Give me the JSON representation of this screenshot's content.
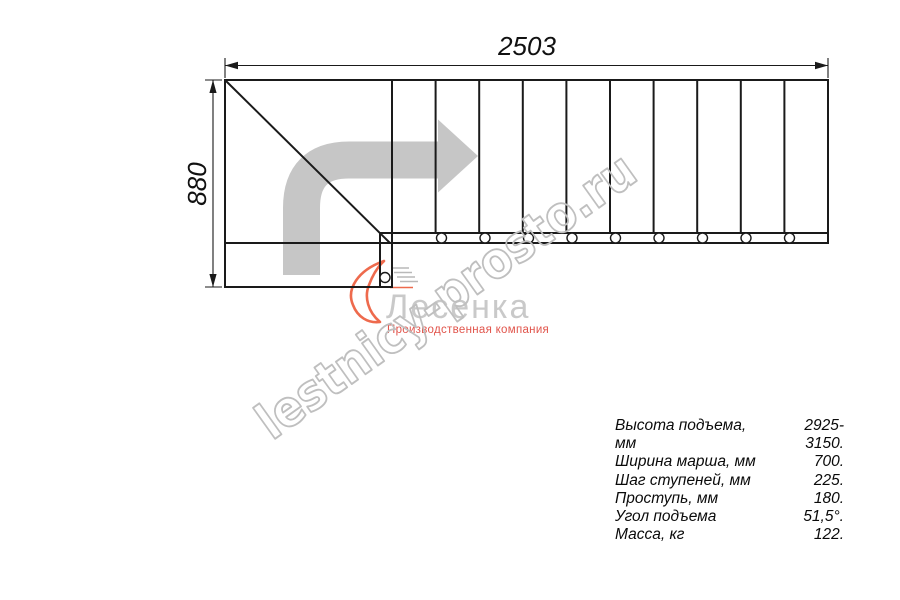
{
  "dimensions": {
    "width_label": "2503",
    "height_label": "880"
  },
  "watermark": {
    "text": "lestnicy-prosto.ru"
  },
  "logo": {
    "name": "Лесенка",
    "tagline": "Производственная компания"
  },
  "specs": {
    "rows": [
      {
        "label": "Высота подъема, мм",
        "value": "2925-3150."
      },
      {
        "label": "Ширина марша, мм",
        "value": "700."
      },
      {
        "label": "Шаг ступеней, мм",
        "value": "225."
      },
      {
        "label": "Проступь, мм",
        "value": "180."
      },
      {
        "label": "Угол подъема",
        "value": "51,5°."
      },
      {
        "label": "Масса, кг",
        "value": "122."
      }
    ]
  },
  "drawing": {
    "colors": {
      "line": "#1a1a1a",
      "arrow": "#c6c6c6",
      "watermark": "#bfbfbf",
      "logo_gray": "#c9c9c9",
      "logo_red": "#e1544b",
      "logo_orange": "#ee6a4d"
    },
    "outer_rect": {
      "x": 225,
      "y": 80,
      "w": 603,
      "h": 163
    },
    "landing_rect": {
      "x": 225,
      "y": 243,
      "w": 167,
      "h": 44
    },
    "strip_line": {
      "x1": 379,
      "y1": 233,
      "x2": 828,
      "y2": 233
    },
    "inner_vertical": {
      "x1": 380,
      "y1": 233,
      "x2": 380,
      "y2": 287
    },
    "first_step_line": {
      "x1": 392,
      "y1": 80,
      "x2": 392,
      "y2": 287
    },
    "diagonal": {
      "x1": 225,
      "y1": 80,
      "x2": 390,
      "y2": 243
    },
    "step_lines_x": [
      435.6,
      479.2,
      522.8,
      566.4,
      610,
      653.6,
      697.2,
      740.8,
      784.4
    ],
    "step_lines_y": {
      "y1": 80,
      "y2": 233
    },
    "tread_circles": {
      "cy": 238,
      "r": 5,
      "xs": [
        441.5,
        485,
        528.5,
        572,
        615.5,
        659,
        702.5,
        746,
        789.5
      ]
    },
    "landing_circle": {
      "cx": 385,
      "cy": 277.5,
      "r": 5
    },
    "direction_arrow": {
      "path": "M301.5 275 L301.5 208 Q301.5 160 349 160 L438 160",
      "stroke_width": 37,
      "head_points": "438,119.5 478,156 438,192.5"
    },
    "dimension_annotations": {
      "top": {
        "line": {
          "x1": 225,
          "y1": 65.5,
          "x2": 828,
          "y2": 65.5
        },
        "ext1": {
          "x1": 225,
          "y1": 58,
          "x2": 225,
          "y2": 78
        },
        "ext2": {
          "x1": 828,
          "y1": 58,
          "x2": 828,
          "y2": 78
        },
        "arrow1": "225,65.5 238,61.8 238,69.2",
        "arrow2": "828,65.5 815,61.8 815,69.2"
      },
      "left": {
        "line": {
          "x1": 213,
          "y1": 80,
          "x2": 213,
          "y2": 287
        },
        "ext1": {
          "x1": 205,
          "y1": 80,
          "x2": 222,
          "y2": 80
        },
        "ext2": {
          "x1": 205,
          "y1": 287,
          "x2": 222,
          "y2": 287
        },
        "arrow1": "213,80 209.4,93 216.6,93",
        "arrow2": "213,287 209.4,274 216.6,274"
      }
    }
  }
}
